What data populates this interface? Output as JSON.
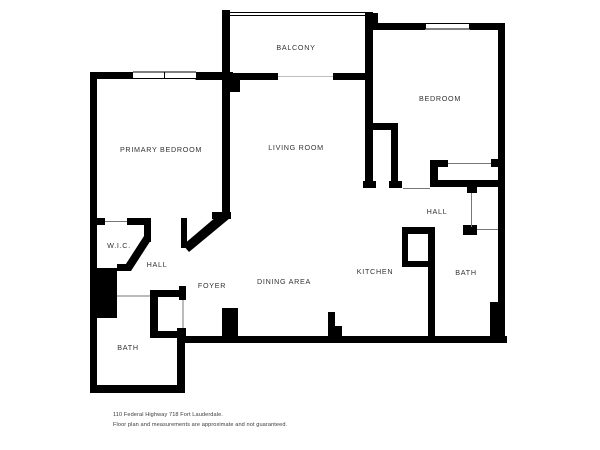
{
  "colors": {
    "background": "#ffffff",
    "walls": "#000000",
    "room_label_text": "#333333",
    "footer_text": "#3a3a3a"
  },
  "rooms": {
    "balcony": "BALCONY",
    "bedroom": "BEDROOM",
    "primary_bedroom": "PRIMARY BEDROOM",
    "living_room": "LIVING ROOM",
    "wic": "W.I.C.",
    "hall_left": "HALL",
    "foyer": "FOYER",
    "dining_area": "DINING AREA",
    "kitchen": "KITCHEN",
    "hall_right": "HALL",
    "bath_left": "BATH",
    "bath_right": "BATH"
  },
  "footer": {
    "address": "110 Federal Highway 718 Fort Lauderdale.",
    "disclaimer": "Floor plan and measurements are approximate and not guaranteed."
  }
}
